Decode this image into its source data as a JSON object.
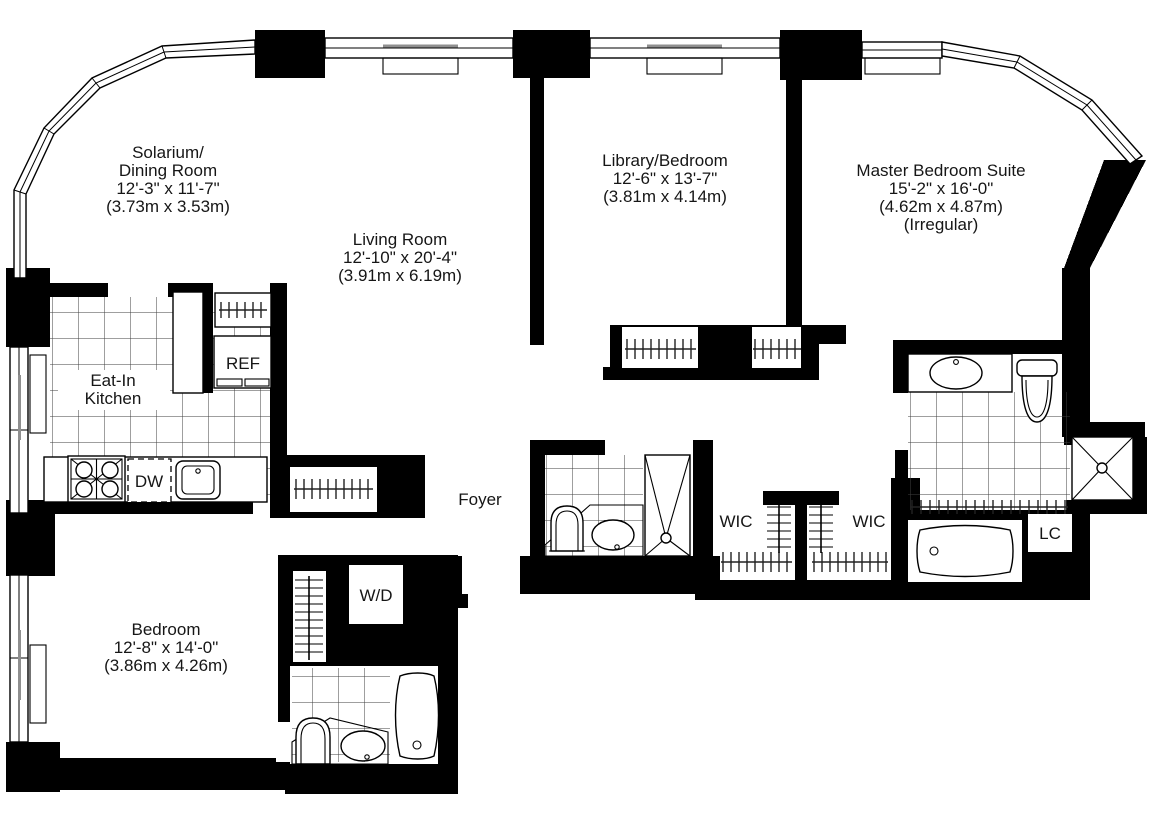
{
  "plan": {
    "title": "apartment-floor-plan",
    "rooms": {
      "solarium": {
        "lines": [
          "Solarium/",
          "Dining Room",
          "12'-3\" x 11'-7\"",
          "(3.73m x 3.53m)"
        ]
      },
      "living": {
        "lines": [
          "Living Room",
          "12'-10\" x 20'-4\"",
          "(3.91m x 6.19m)"
        ]
      },
      "library": {
        "lines": [
          "Library/Bedroom",
          "12'-6\" x 13'-7\"",
          "(3.81m x 4.14m)"
        ]
      },
      "master": {
        "lines": [
          "Master Bedroom Suite",
          "15'-2\" x 16'-0\"",
          "(4.62m x 4.87m)",
          "(Irregular)"
        ]
      },
      "kitchen": {
        "lines": [
          "Eat-In",
          "Kitchen"
        ]
      },
      "bedroom": {
        "lines": [
          "Bedroom",
          "12'-8\" x 14'-0\"",
          "(3.86m x 4.26m)"
        ]
      },
      "foyer": {
        "label": "Foyer"
      },
      "wic_left": {
        "label": "WIC"
      },
      "wic_right": {
        "label": "WIC"
      },
      "linen_closet": {
        "label": "LC"
      },
      "washer_dryer": {
        "label": "W/D"
      },
      "refrigerator": {
        "label": "REF"
      },
      "dishwasher": {
        "label": "DW"
      }
    },
    "colors": {
      "walls": "#000000",
      "background": "#ffffff",
      "tile_lines": "#3f3f3f",
      "window_sash": "#8f8f8f",
      "text": "#161616"
    }
  }
}
